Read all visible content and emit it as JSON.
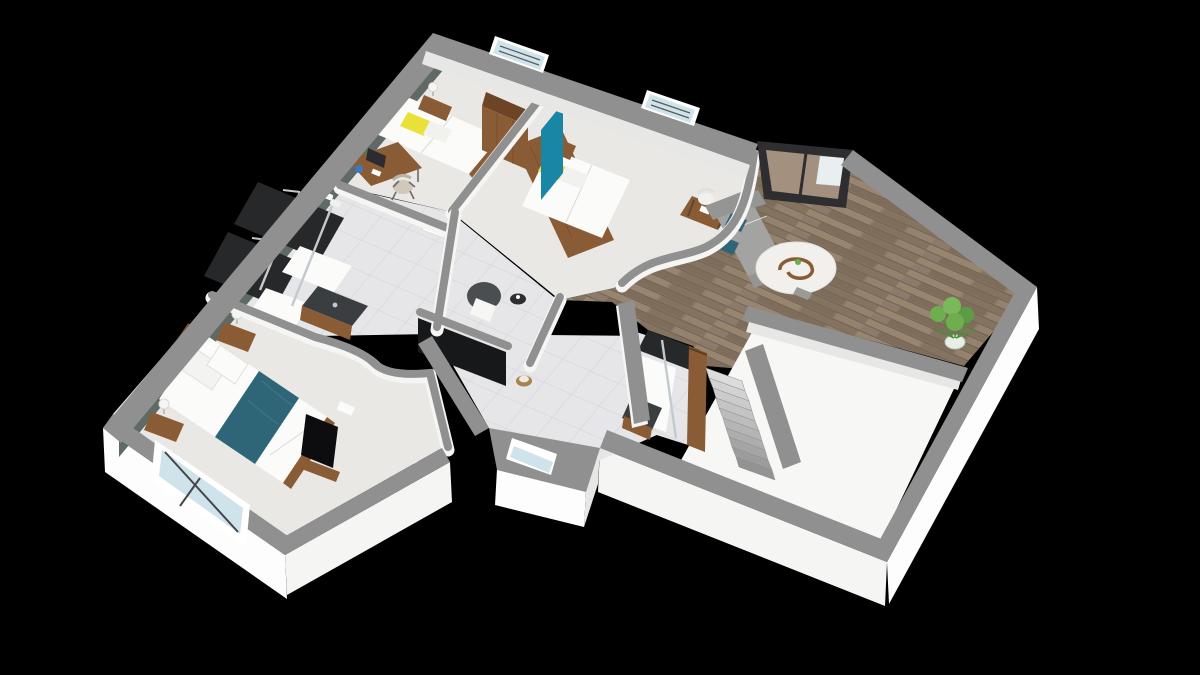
{
  "scene": {
    "type": "3d-floorplan-render",
    "view": "aerial-dollhouse-perspective",
    "background": "#000000",
    "rooms": [
      {
        "name": "bedroom-1",
        "floor": "light-carpet",
        "furniture": [
          "single-bed-white-bedding",
          "yellow-accent-pillow",
          "wood-headboard",
          "nightstand-with-lamp",
          "writing-desk-with-monitor",
          "desk-chair",
          "wood-wardrobe",
          "interior-door"
        ]
      },
      {
        "name": "bedroom-2",
        "floor": "light-carpet",
        "accent_wall": "teal",
        "furniture": [
          "double-bed-white-bedding",
          "yellow-accent-pillow",
          "tall-wood-headboard-unit",
          "nightstand-with-lamp",
          "desk-with-white-chair",
          "curved-partition-wall"
        ]
      },
      {
        "name": "family-bathroom",
        "floor": "tile",
        "furniture": [
          "walk-in-shower-dark-tiles",
          "second-shower-dark-tiles",
          "glass-shower-screens",
          "dark-sink-vanity-on-wood-cabinet",
          "towel-shelf"
        ]
      },
      {
        "name": "dressing-lounge",
        "floor": "tile",
        "furniture": [
          "dark-accent-panel",
          "gray-tub-armchair-with-white-throw",
          "round-side-table",
          "small-stool"
        ]
      },
      {
        "name": "master-bedroom",
        "floor": "light-carpet",
        "accent_wall": "dark-green",
        "furniture": [
          "double-bed-white-duvet",
          "teal-bed-runner",
          "wood-bed-frame",
          "two-nightstands-with-lamps",
          "leaning-tv-screen",
          "wood-tv-stand",
          "large-corner-window"
        ]
      },
      {
        "name": "hallway",
        "floor": "tile",
        "furniture": [
          "window-bay"
        ]
      },
      {
        "name": "shower-room",
        "floor": "tile",
        "furniture": [
          "walk-in-shower-dark-tiles",
          "glass-screen",
          "dark-sink-vanity"
        ]
      },
      {
        "name": "living-area",
        "floor": "wood-plank",
        "furniture": [
          "gray-sofa",
          "two-teal-cushions",
          "round-white-rug",
          "sculptural-wood-coffee-table",
          "potted-plant",
          "sliding-glass-door"
        ]
      },
      {
        "name": "stairwell",
        "furniture": [
          "staircase-descending",
          "wood-balustrade-wall"
        ]
      },
      {
        "name": "unfurnished-room",
        "floor": "bare",
        "furniture": []
      }
    ],
    "windows": [
      "bedroom-1-top-wall",
      "bedroom-2-top-wall",
      "living-sliding-door",
      "hallway-bay",
      "master-corner-window"
    ]
  },
  "colors": {
    "bg": "#000000",
    "wall_top": "#909090",
    "wall_top_light": "#a3a3a3",
    "wall_face": "#f5f5f4",
    "wall_face_bright": "#fdfdfd",
    "wall_face_shadow": "#e7e7e6",
    "green_wall": "#5e6a63",
    "teal_wall": "#1a86a5",
    "floor_light": "#eae8e4",
    "floor_tile": "#e6e6e8",
    "floor_wood": "#8d7a6b",
    "floor_bare": "#f7f7f6",
    "wood": "#8a5c35",
    "wood_dark": "#6e4426",
    "yellow": "#e9e139",
    "teal_textile": "#2e6577",
    "sofa_gray": "#a3a3a1",
    "rug": "#f2f0ec",
    "dark_tile": "#26282a",
    "dark_counter": "#3b3e41",
    "tv_black": "#0d0d0f",
    "chair_dark": "#4b4e50",
    "stair_light": "#d6d6d6",
    "stair_dark": "#9c9c9c",
    "plant_green": "#6fae4e",
    "plant_green_dark": "#4e8f3a",
    "glass": "#cfe3ea",
    "frame_dark": "#2e2e30",
    "chrome": "#c3cacd",
    "white": "#fbfbfa"
  }
}
